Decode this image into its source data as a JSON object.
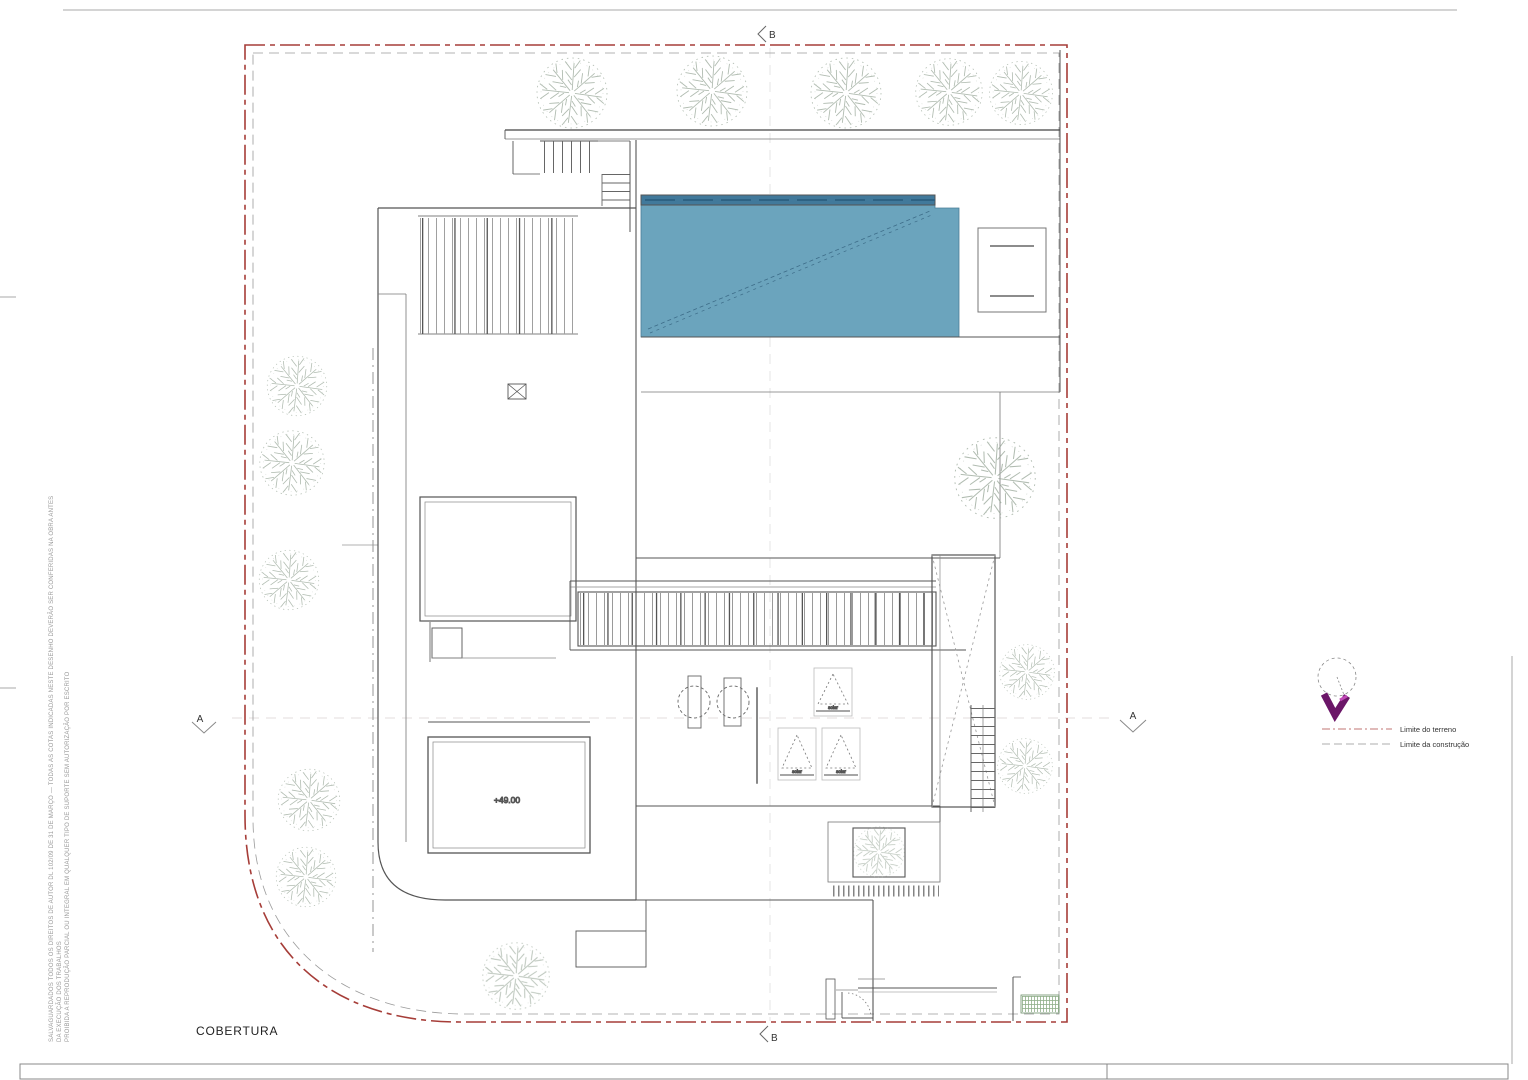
{
  "title": "COBERTURA",
  "labels": {
    "level": "+49.00",
    "solar": "solar",
    "section_a": "A",
    "section_b": "B"
  },
  "legend": {
    "terrain": "Limite do terreno",
    "construction": "Limite da construção"
  },
  "disclaimer": {
    "line1": "SALVAGUARDADOS TODOS OS DIREITOS DE AUTOR DL 102/09 DE 31 DE MARÇO — TODAS AS COTAS INDICADAS NESTE DESENHO DEVERÃO SER CONFERIDAS NA OBRA ANTES",
    "line2": "DA EXECUÇÃO DOS TRABALHOS",
    "line3": "PROIBIDA A REPRODUÇÃO PARCIAL OU INTEGRAL EM QUALQUER TIPO DE SUPORTE SEM AUTORIZAÇÃO POR ESCRITO"
  },
  "colors": {
    "terrain_limit": "#a63d38",
    "construction_limit": "#9a9a9a",
    "pool_fill": "#6ba4bd",
    "pool_dark": "#41799b",
    "vegetation": "#97a697",
    "north_arrow": "#6b1668"
  }
}
